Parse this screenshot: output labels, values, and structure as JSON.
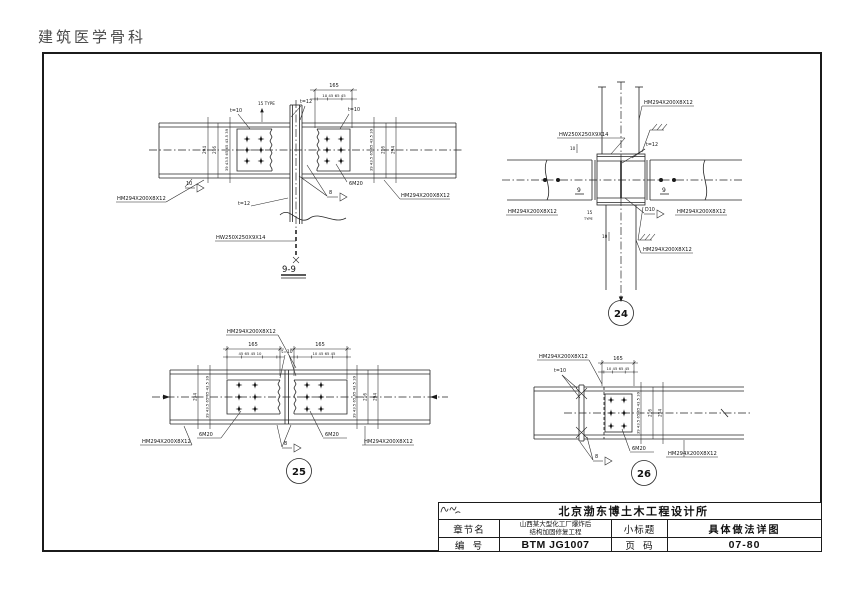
{
  "watermark": "建筑医学骨科",
  "shared": {
    "beam_size": "HM294X200X8X12",
    "column_size": "HW250X250X9X14",
    "bolt_group": "6M20",
    "t10": "t=10",
    "t12": "t=12",
    "weld_8": "8",
    "weld_10": "10",
    "weld_d10": "D10",
    "typ_15": "15",
    "typ_word": "TYPE",
    "typ_15_inline": "15 TYPE"
  },
  "dims": {
    "total_165": "165",
    "sub_left": "45 65 45 10",
    "sub_right": "10 45 65 45",
    "stack_vertical": "39 43.5 65 65 43.5 39",
    "depth_216": "216",
    "depth_294": "294",
    "gap_10": "10"
  },
  "sections": {
    "title_9_9": "9-9",
    "mark_9": "9"
  },
  "badges": {
    "detail_24": "24",
    "detail_25": "25",
    "detail_26": "26"
  },
  "title_block": {
    "company": "北京渤东博土木工程设计所",
    "chapter_label": "章节名",
    "chapter_value_line1": "山西某大型化工厂爆炸后",
    "chapter_value_line2": "结构加固修复工程",
    "subtitle_label": "小标题",
    "subtitle_value": "具体做法详图",
    "number_label": "编  号",
    "number_value": "BTM JG1007",
    "page_label": "页  码",
    "page_value": "07-80"
  }
}
